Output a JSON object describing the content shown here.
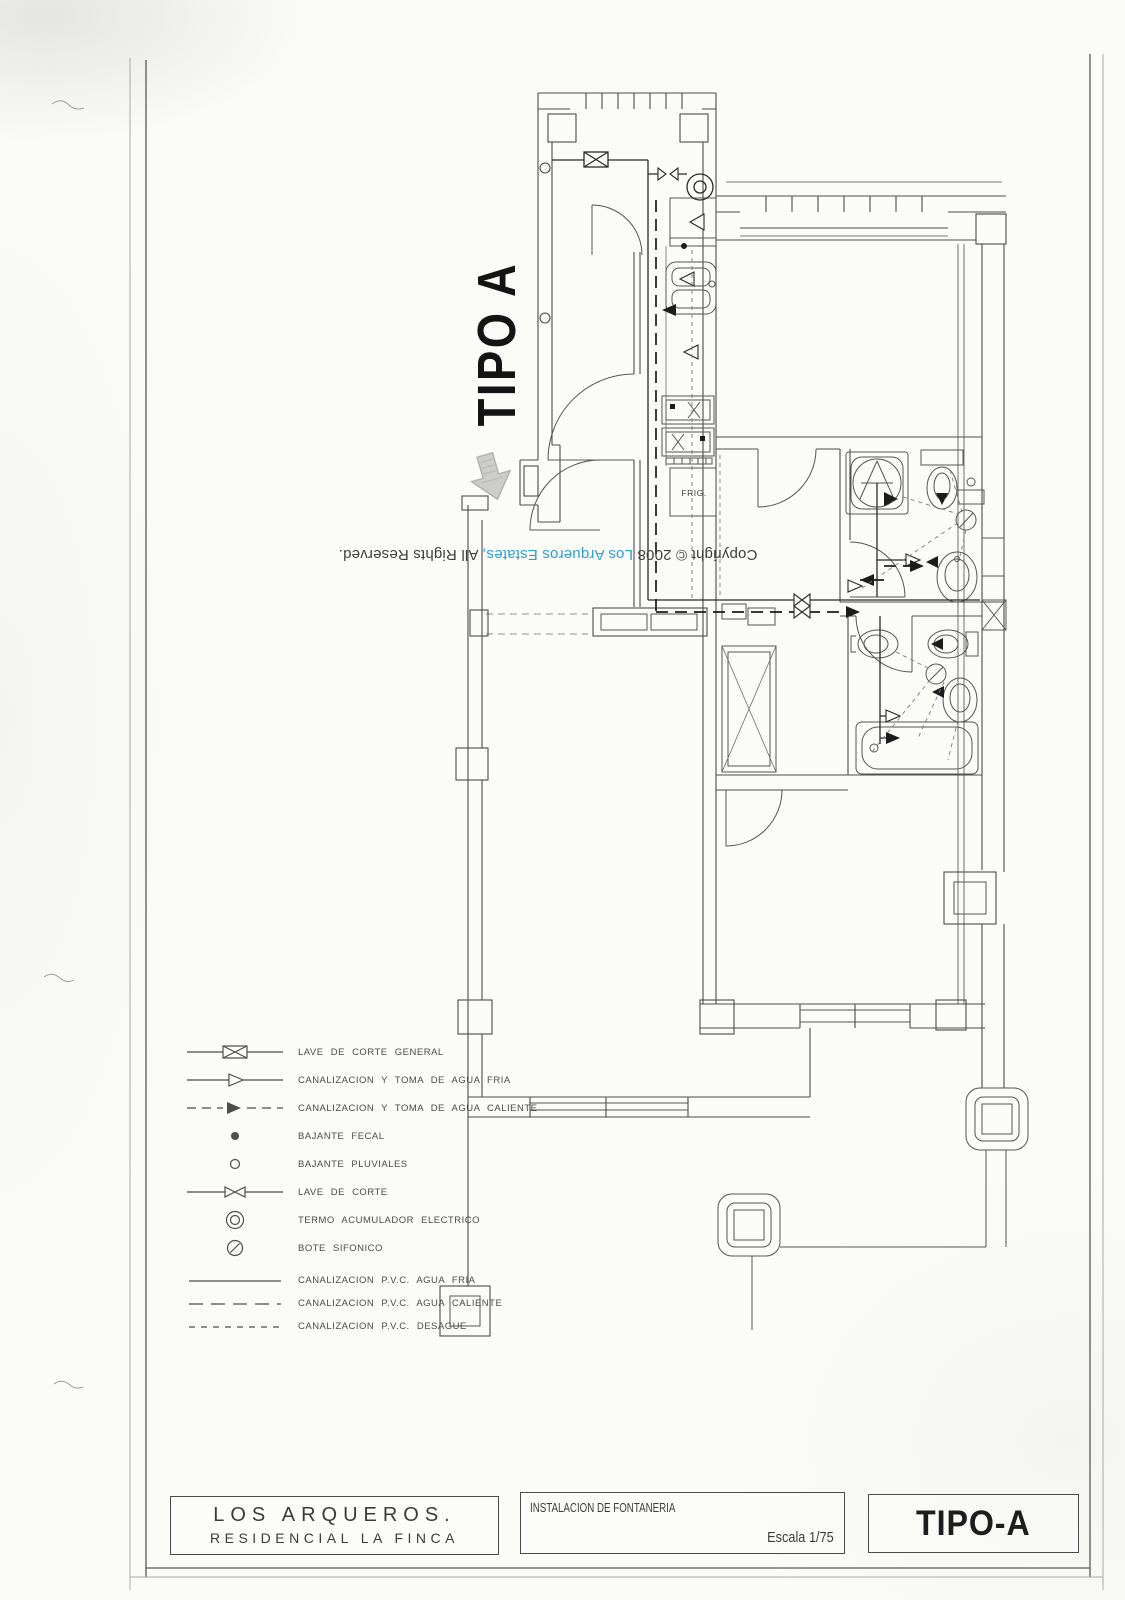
{
  "page": {
    "tipo_vertical_label": "TIPO A",
    "copyright": {
      "prefix": "Copyright © 2008 ",
      "highlight": "Los Arqueros Estates,",
      "suffix": " All Rights Reserved."
    },
    "accent_blue": "#2e9fd3"
  },
  "plan": {
    "frig_label": "FRIG."
  },
  "legend": {
    "items": [
      {
        "symbol": "general-shutoff-valve-icon",
        "label": "LAVE DE CORTE GENERAL"
      },
      {
        "symbol": "cold-water-supply-icon",
        "label": "CANALIZACION Y TOMA DE AGUA FRIA"
      },
      {
        "symbol": "hot-water-supply-icon",
        "label": "CANALIZACION Y TOMA DE AGUA CALIENTE"
      },
      {
        "symbol": "soil-downpipe-icon",
        "label": "BAJANTE FECAL"
      },
      {
        "symbol": "rainwater-downpipe-icon",
        "label": "BAJANTE PLUVIALES"
      },
      {
        "symbol": "shutoff-valve-icon",
        "label": "LAVE DE CORTE"
      },
      {
        "symbol": "electric-water-heater-icon",
        "label": "TERMO ACUMULADOR ELECTRICO"
      },
      {
        "symbol": "siphon-trap-icon",
        "label": "BOTE SIFONICO"
      },
      {
        "symbol": "pvc-cold-water-line-icon",
        "label": "CANALIZACION P.V.C. AGUA FRIA"
      },
      {
        "symbol": "pvc-hot-water-line-icon",
        "label": "CANALIZACION P.V.C. AGUA CALIENTE"
      },
      {
        "symbol": "pvc-drain-line-icon",
        "label": "CANALIZACION P.V.C. DESAGUE"
      }
    ]
  },
  "title_block": {
    "project_line1": "LOS ARQUEROS.",
    "project_line2": "RESIDENCIAL LA FINCA",
    "drawing_title": "INSTALACION DE FONTANERIA",
    "scale": "Escala 1/75",
    "type_label": "TIPO-A"
  }
}
